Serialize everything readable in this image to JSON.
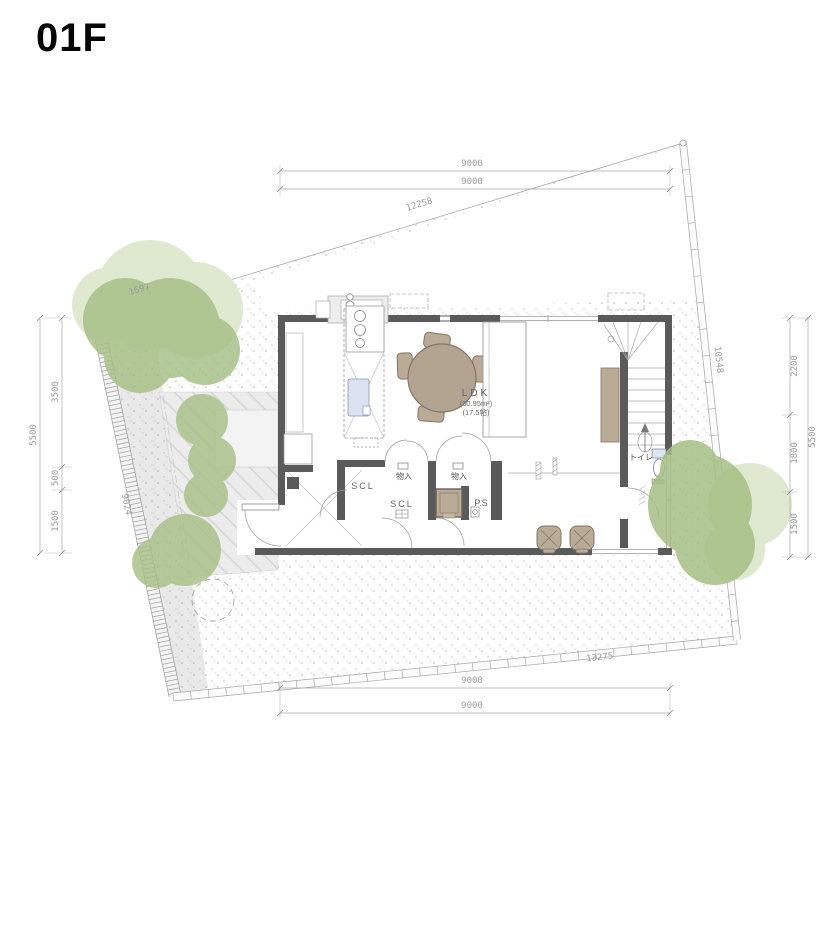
{
  "title": "01F",
  "colors": {
    "wall": "#5a5a5a",
    "tree": "#a6bf85",
    "tree_light": "#dfe9cf",
    "furniture": "#b9ab95",
    "table": "#b3a492",
    "sink": "#dde2f2",
    "boundary_line": "#a5a5a5",
    "dimension_text": "#9a9a9a"
  },
  "dimensions": {
    "top": {
      "lines": [
        "9000",
        "9000"
      ],
      "boundary": "12258",
      "boundary_short": "1697"
    },
    "bottom": {
      "boundary": "13275",
      "lines": [
        "9000",
        "9000"
      ]
    },
    "left": {
      "segments": [
        "3500",
        "500",
        "1500"
      ],
      "overall": "5500",
      "boundary": "9024"
    },
    "right": {
      "segments": [
        "2200",
        "1800",
        "1500"
      ],
      "overall": "5500",
      "boundary": "10548"
    }
  },
  "rooms": {
    "ldk": {
      "name": "LDK",
      "area_m2": "(30.95m²)",
      "area_tatami": "(17.5帖)"
    },
    "shoes_closet_1": "SCL",
    "shoes_closet_2": "SCL",
    "storage_1": "物入",
    "storage_2": "物入",
    "pipe_space": "P.S",
    "toilet": "トイレ"
  }
}
